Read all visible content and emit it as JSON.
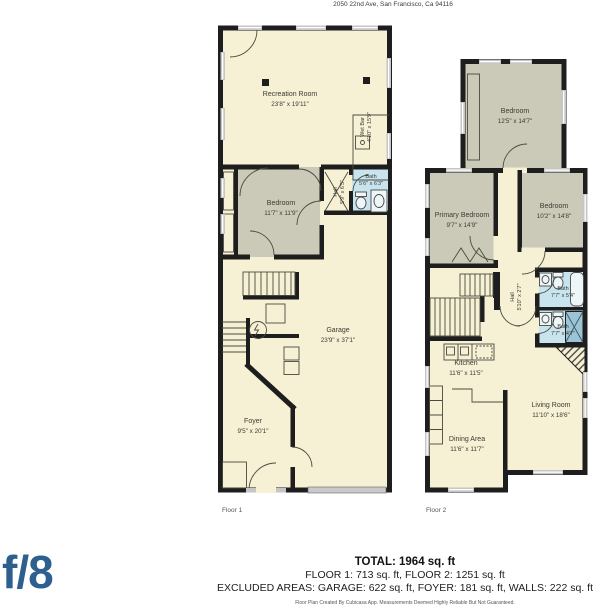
{
  "header": {
    "address": "2050 22nd Ave, San Francisco, Ca 94116"
  },
  "floor1": {
    "label": "Floor 1",
    "rooms": {
      "recreation": {
        "name": "Recreation Room",
        "dims": "23'8\" x 19'11\""
      },
      "wet_bar": {
        "name": "Wet Bar",
        "dims": "4'10\" x 15'9\""
      },
      "bedroom": {
        "name": "Bedroom",
        "dims": "11'7\" x 11'9\""
      },
      "hall": {
        "name": "Hall",
        "dims": "5'9\" x 6'5\""
      },
      "bath": {
        "name": "Bath",
        "dims": "5'6\" x 6'3\""
      },
      "garage": {
        "name": "Garage",
        "dims": "23'9\" x 37'1\""
      },
      "foyer": {
        "name": "Foyer",
        "dims": "9'5\" x 20'1\""
      }
    }
  },
  "floor2": {
    "label": "Floor 2",
    "rooms": {
      "bedroom_top": {
        "name": "Bedroom",
        "dims": "12'5\" x 14'7\""
      },
      "primary_bedroom": {
        "name": "Primary Bedroom",
        "dims": "9'7\" x 14'9\""
      },
      "bedroom_right": {
        "name": "Bedroom",
        "dims": "10'2\" x 14'8\""
      },
      "hall": {
        "name": "Hall",
        "dims": "5'10\" x 2'7\""
      },
      "bath_upper": {
        "name": "Bath",
        "dims": "7'7\" x 5'4\""
      },
      "bath_lower": {
        "name": "Bath",
        "dims": "7'7\" x 4'7\""
      },
      "kitchen": {
        "name": "Kitchen",
        "dims": "11'6\" x 11'5\""
      },
      "living_room": {
        "name": "Living Room",
        "dims": "11'10\" x 18'6\""
      },
      "dining_area": {
        "name": "Dining Area",
        "dims": "11'6\" x 11'7\""
      }
    }
  },
  "footer": {
    "total": "TOTAL: 1964 sq. ft",
    "floors": "FLOOR 1: 713 sq. ft, FLOOR 2: 1251 sq. ft",
    "excluded": "EXCLUDED AREAS: GARAGE: 622 sq. ft, FOYER: 181 sq. ft, WALLS: 222 sq. ft",
    "disclaimer": "Floor Plan Created By Cubicasa App. Measurements Deemed Highly Reliable But Not Guaranteed."
  },
  "logo": {
    "text": "f/8"
  },
  "colors": {
    "brand_blue": "#2d608f",
    "floor_fill": "#f6f0d4",
    "bedroom_fill": "#cbcab8",
    "bath_fill": "#c8e4ee",
    "wall": "#1e1e1e"
  }
}
